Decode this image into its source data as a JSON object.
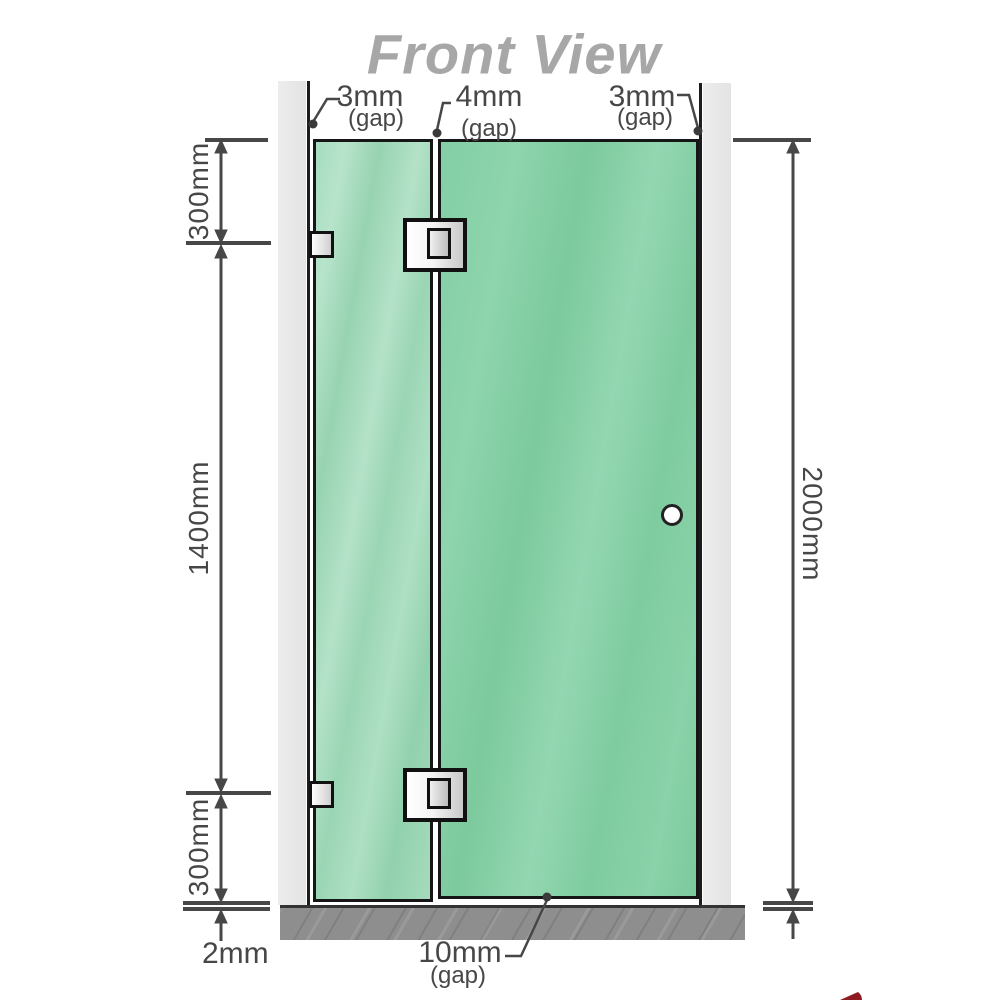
{
  "title": "Front View",
  "gaps": {
    "left": {
      "value": "3mm",
      "note": "(gap)"
    },
    "middle": {
      "value": "4mm",
      "note": "(gap)"
    },
    "right": {
      "value": "3mm",
      "note": "(gap)"
    },
    "bottom": {
      "value": "10mm",
      "note": "(gap)"
    }
  },
  "dims": {
    "top": "300mm",
    "middle": "1400mm",
    "bottom": "300mm",
    "floor": "2mm",
    "total": "2000mm"
  },
  "colors": {
    "glass_left": "#9bd6b5",
    "glass_right": "#82cfa4",
    "channel_gray": "#e9e9e9",
    "floor_gray": "#8e8e8e",
    "line_dark": "#474747",
    "title_gray": "#a7a7a7",
    "logo_red": "#8e1a22"
  }
}
